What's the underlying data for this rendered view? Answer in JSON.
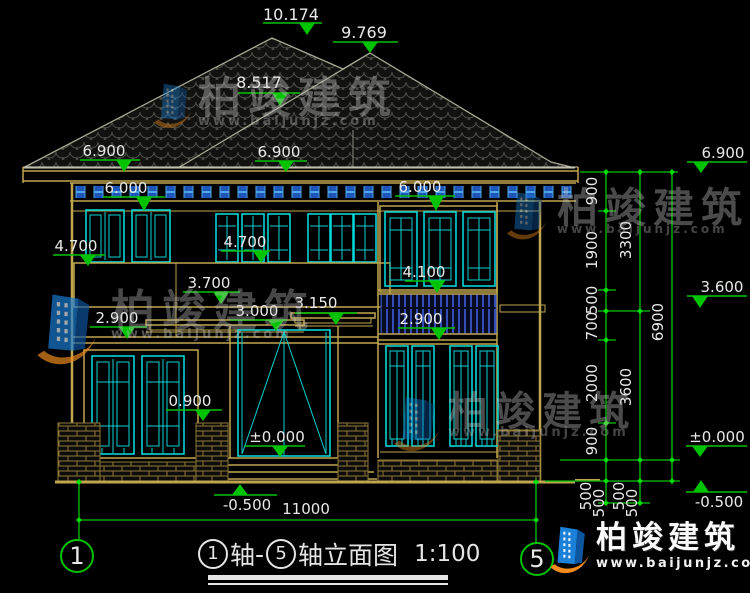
{
  "drawing_title": {
    "axis_left": "1",
    "axis_word": "轴",
    "dash": "-",
    "axis_right": "5",
    "name": "轴立面图",
    "scale": "1:100",
    "left_bubble": "1",
    "right_bubble": "5"
  },
  "markers": [
    {
      "label": "10.174"
    },
    {
      "label": "9.769"
    },
    {
      "label": "8.517"
    },
    {
      "label": "6.900"
    },
    {
      "label": "6.900"
    },
    {
      "label": "6.900"
    },
    {
      "label": "6.000"
    },
    {
      "label": "6.000"
    },
    {
      "label": "4.700"
    },
    {
      "label": "4.700"
    },
    {
      "label": "3.700"
    },
    {
      "label": "4.100"
    },
    {
      "label": "3.000"
    },
    {
      "label": "3.150"
    },
    {
      "label": "2.900"
    },
    {
      "label": "2.900"
    },
    {
      "label": "3.600"
    },
    {
      "label": "0.900"
    },
    {
      "label": "±0.000"
    },
    {
      "label": "±0.000"
    },
    {
      "label": "-0.500"
    },
    {
      "label": "-0.500"
    }
  ],
  "dims": {
    "chain_a": [
      "900",
      "1900",
      "500",
      "700",
      "2000",
      "900",
      "500",
      "500"
    ],
    "chain_b": [
      "3300",
      "3600",
      "500",
      "500"
    ],
    "chain_c": [
      "6900"
    ],
    "bottom_width": "11000"
  },
  "watermark": {
    "brand": "柏竣建筑",
    "url": "www.baijunjz.com"
  },
  "logo": {
    "brand": "柏竣建筑",
    "url": "www.baijunjz.com"
  },
  "colors": {
    "dimension_green": "#00C300",
    "wall_tan": "#BFA64F",
    "window_cyan": "#00D4D4",
    "brand_blue": "#1B80D8",
    "brand_orange": "#F28C1E"
  }
}
